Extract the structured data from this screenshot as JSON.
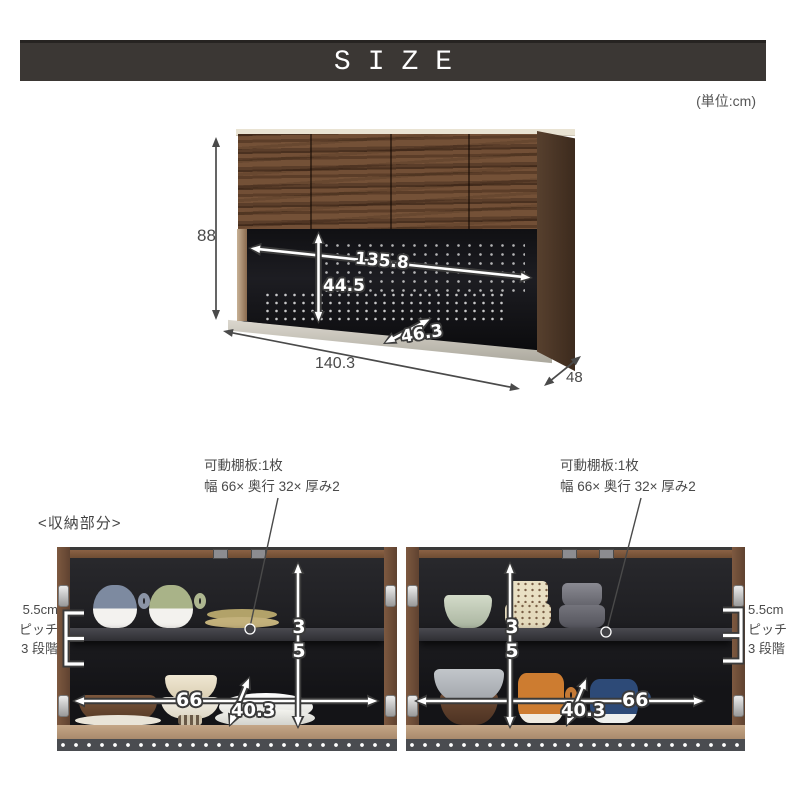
{
  "header": {
    "title": "SIZE",
    "unit_note": "(単位:cm)"
  },
  "main_diagram": {
    "dim_height": "88",
    "dim_inner_width": "135.8",
    "dim_inner_height": "44.5",
    "dim_inner_depth": "46.3",
    "dim_outer_width": "140.3",
    "dim_outer_depth": "48"
  },
  "storage": {
    "heading": "<収納部分>",
    "shelf_note_left": {
      "line1": "可動棚板:1枚",
      "line2": "幅 66× 奥行 32× 厚み2"
    },
    "shelf_note_right": {
      "line1": "可動棚板:1枚",
      "line2": "幅 66× 奥行 32× 厚み2"
    },
    "pitch_note_left": {
      "line1": "5.5cm",
      "line2": "ピッチ",
      "line3": "3 段階"
    },
    "pitch_note_right": {
      "line1": "5.5cm",
      "line2": "ピッチ",
      "line3": "3 段階"
    },
    "left_photo": {
      "dim_width": "66",
      "dim_height": "35",
      "dim_depth": "40.3"
    },
    "right_photo": {
      "dim_width": "66",
      "dim_height": "35",
      "dim_depth": "40.3"
    }
  },
  "colors": {
    "header_bar": "#3b3734",
    "dimension_text": "#4a4a4a",
    "wood": "#6b4a33",
    "interior_black": "#1a1a1d"
  }
}
